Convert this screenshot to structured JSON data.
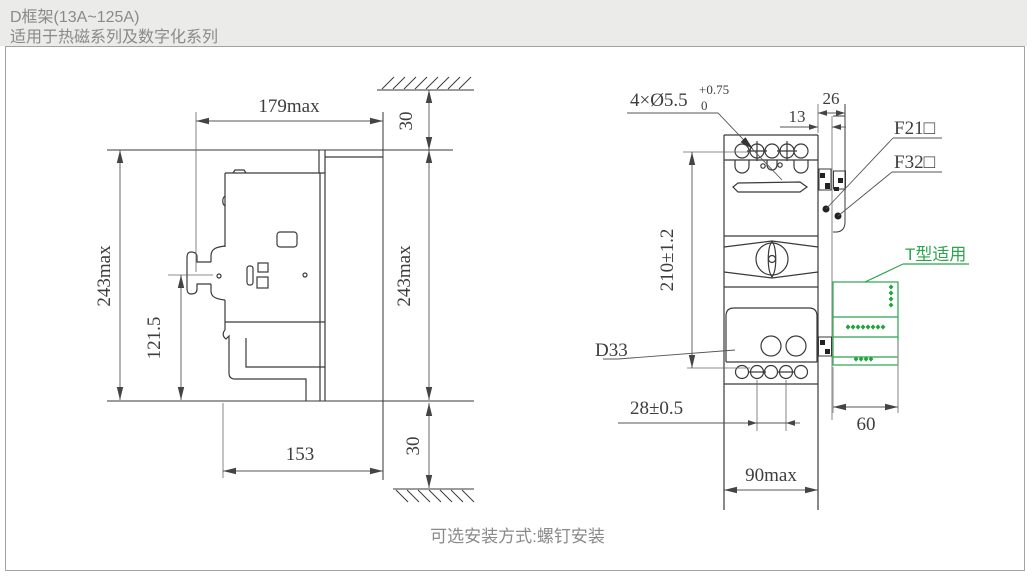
{
  "header": {
    "title": "D框架(13A~125A)",
    "subtitle": "适用于热磁系列及数字化系列"
  },
  "footer": {
    "caption": "可选安装方式:螺钉安装"
  },
  "colors": {
    "accent_green": "#2ca54e",
    "header_bg": "#ebebe9",
    "line": "#3a3a3a",
    "muted_text": "#8a8a8a"
  },
  "side_view": {
    "dim_width": "179max",
    "dim_height_left": "243max",
    "dim_height_right": "243max",
    "dim_handle_center": "121.5",
    "dim_depth": "153",
    "dim_top_clearance": "30",
    "dim_bottom_clearance": "30"
  },
  "front_view": {
    "label_holes": "4×Ø5.5",
    "holes_tol_upper": "+0.75",
    "holes_tol_lower": "0",
    "dim_offset": "13",
    "dim_rail": "26",
    "label_f21": "F21□",
    "label_f32": "F32□",
    "label_t_type": "T型适用",
    "dim_height": "210±1.2",
    "label_d33": "D33",
    "dim_hole_spacing": "28±0.5",
    "dim_width": "90max",
    "dim_accessory_width": "60"
  }
}
